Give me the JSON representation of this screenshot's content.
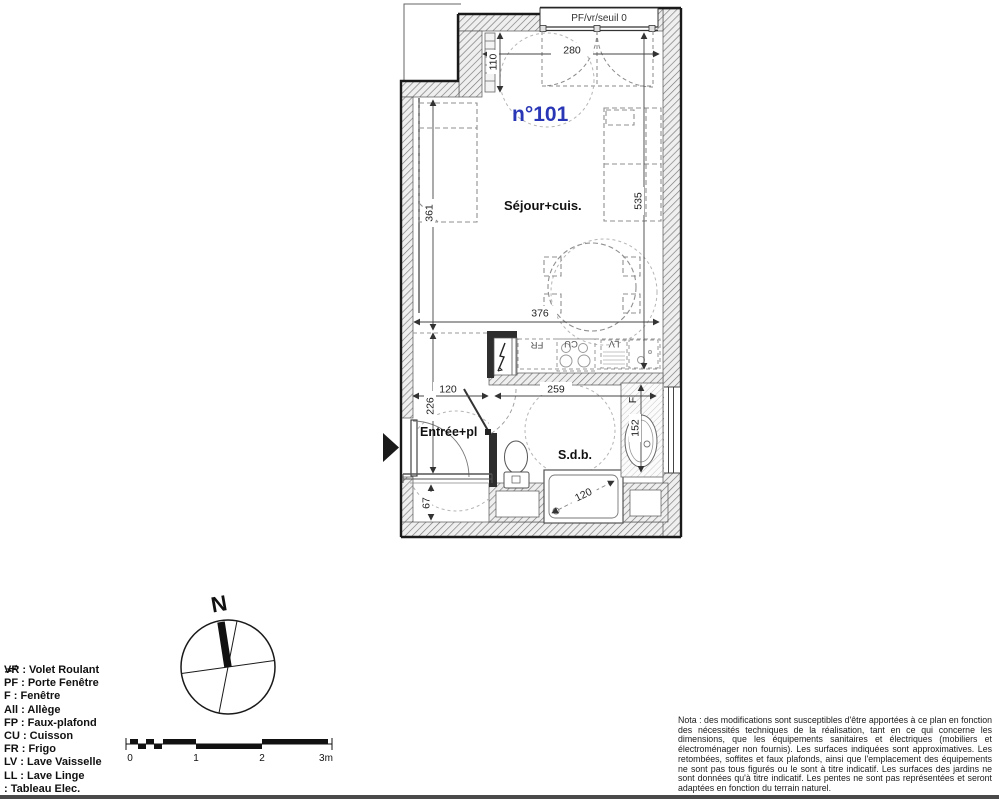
{
  "plan": {
    "unit_number": "n°101",
    "top_label": "PF/vr/seuil 0",
    "rooms": {
      "living": "Séjour+cuis.",
      "entry": "Entrée+pl",
      "bath": "S.d.b."
    },
    "appliances": {
      "fridge": "FR",
      "cooktop": "CU",
      "dishwasher": "LV"
    },
    "window_label": "F",
    "dims": {
      "top_width": "280",
      "radiator_len": "110",
      "living_left": "361",
      "living_right": "535",
      "living_width": "376",
      "hall_width": "120",
      "entry_len": "226",
      "bath_width": "259",
      "bath_depth": "152",
      "shower_width": "120",
      "closet_depth": "67"
    }
  },
  "compass": {
    "north_label": "N"
  },
  "scale_bar": {
    "tick0": "0",
    "tick1": "1",
    "tick2": "2",
    "tick3": "3m"
  },
  "legend": {
    "items": [
      "VR : Volet Roulant",
      "PF : Porte Fenêtre",
      "F : Fenêtre",
      "All : Allège",
      "FP : Faux-plafond",
      "CU : Cuisson",
      "FR : Frigo",
      "LV : Lave Vaisselle",
      "LL : Lave Linge"
    ],
    "elec_row": ": Tableau Elec."
  },
  "nota": {
    "text": "Nota : des modifications sont susceptibles d'être apportées à ce plan en fonction des nécessités techniques de la réalisation, tant en ce qui concerne les dimensions, que les équipements sanitaires et électriques (mobiliers et électroménager non fournis). Les surfaces indiquées sont approximatives. Les retombées, soffites et faux plafonds, ainsi que l'emplacement des équipements ne sont pas tous figurés ou le sont à titre indicatif. Les surfaces des jardins ne sont données qu'à titre indicatif. Les pentes ne sont pas représentées et seront adaptées en fonction du terrain naturel."
  }
}
